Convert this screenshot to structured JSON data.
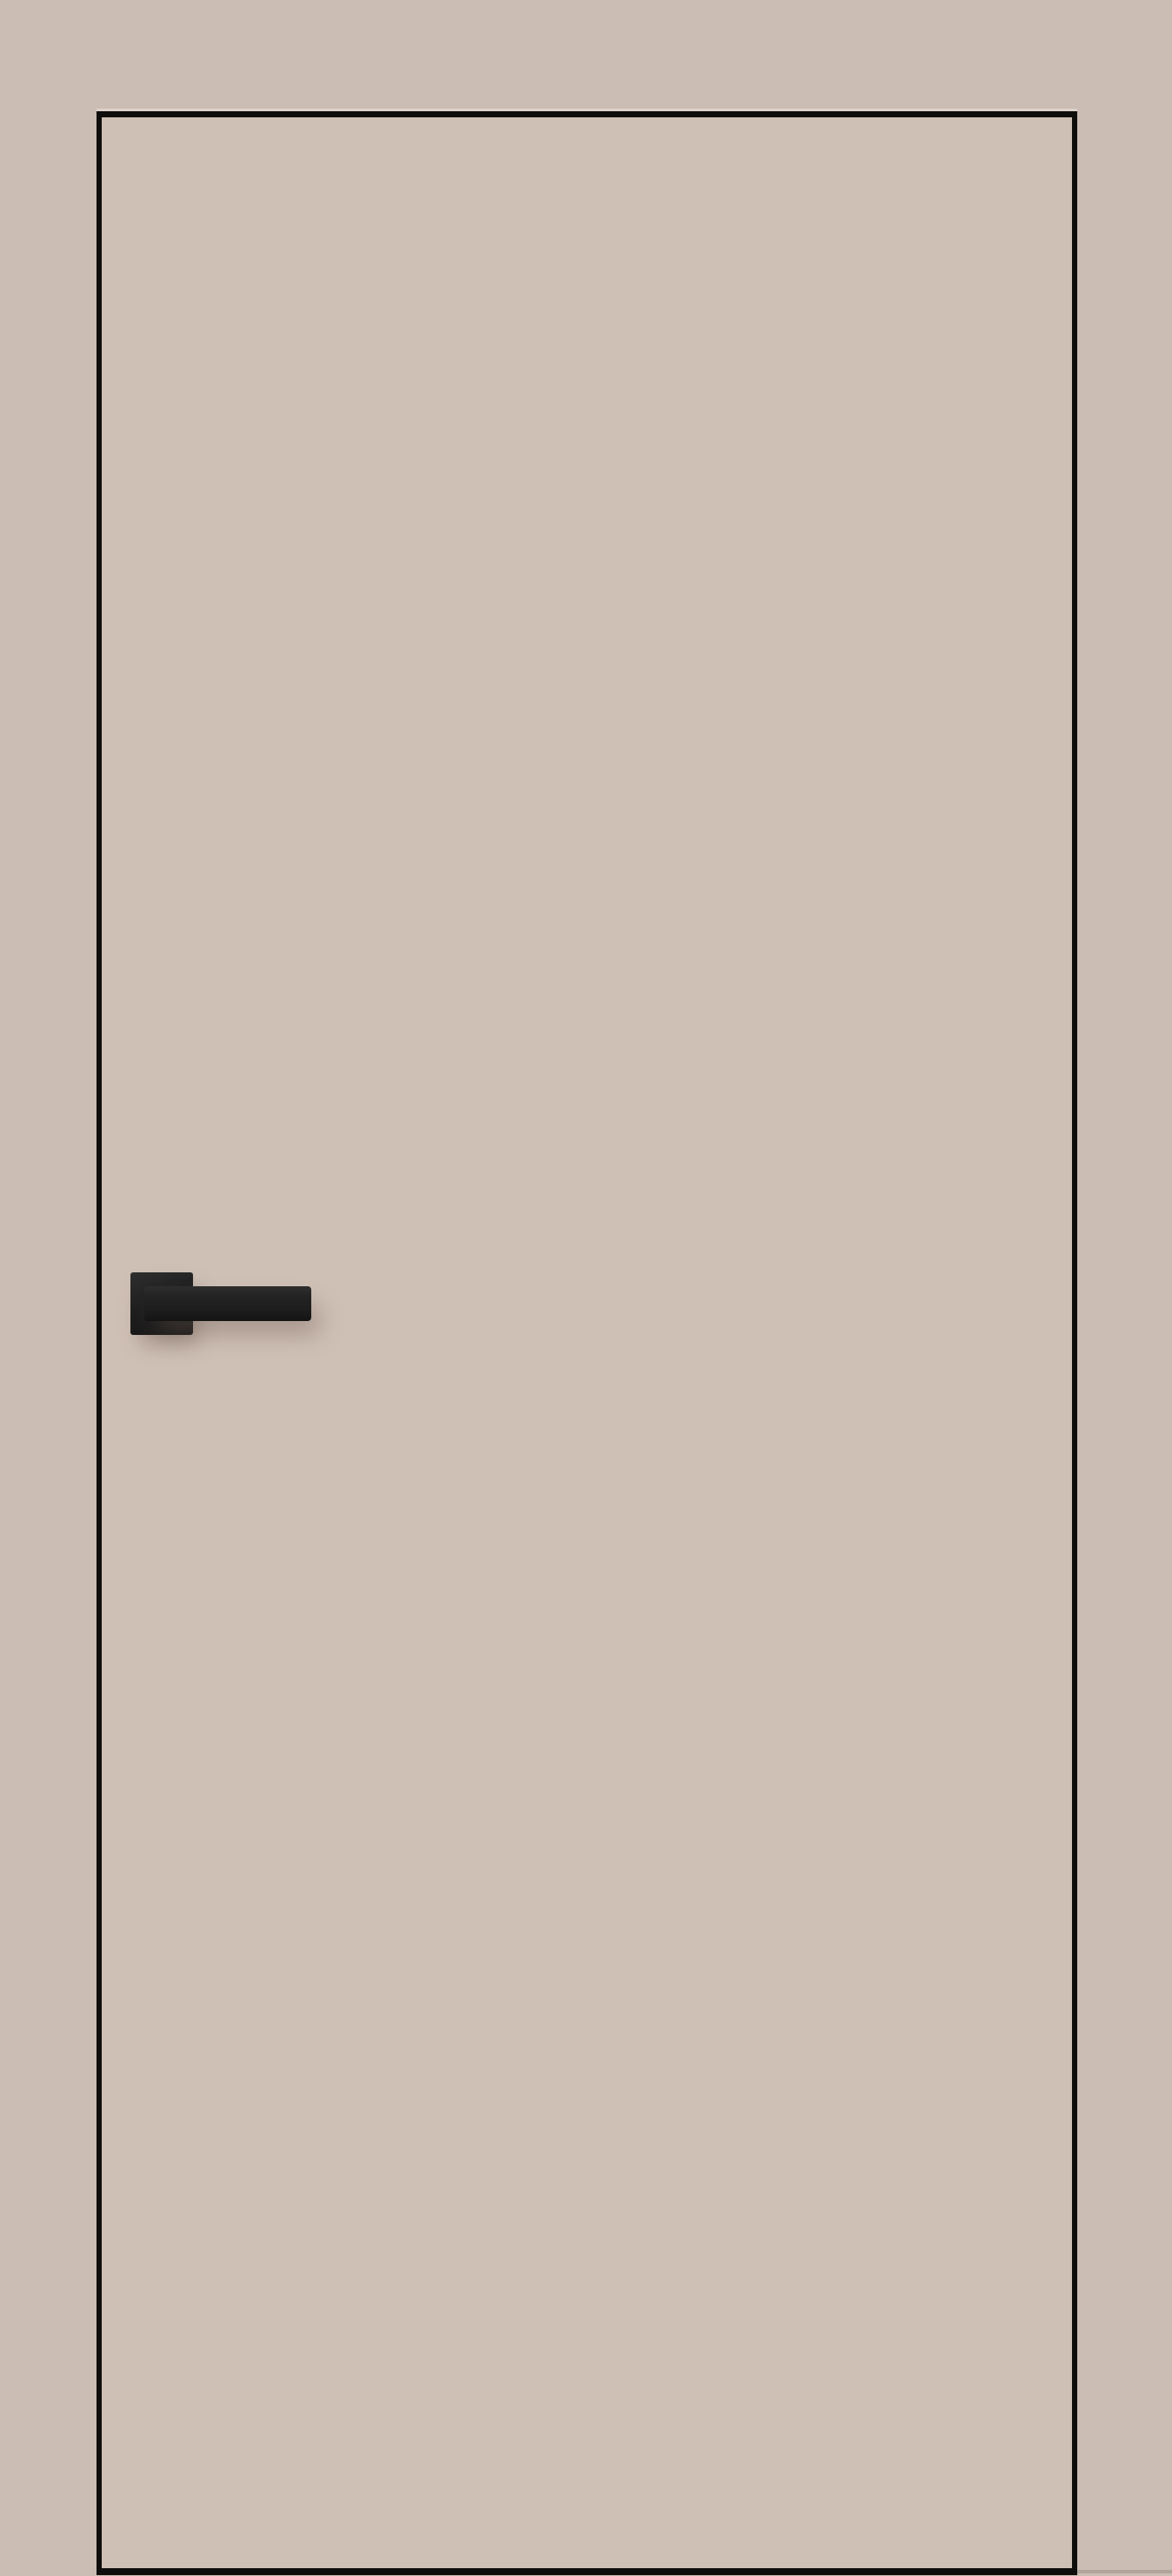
{
  "scene": {
    "subject": "flush-interior-door-with-black-lever-handle",
    "objects": {
      "wall": "wall-background",
      "door": "door-leaf",
      "edge_outline": "door-edge-gap-line",
      "handle_rose": "door-handle-rose",
      "handle_lever": "door-handle-lever"
    },
    "colors": {
      "wall": "#cbbdb3",
      "door": "#cfc0b5",
      "edge": "#0f0e0c",
      "handle-dark": "#1d1d1d",
      "handle-light": "#2e2e2e",
      "shadow": "rgba(108, 92, 82, 0.45)"
    }
  }
}
